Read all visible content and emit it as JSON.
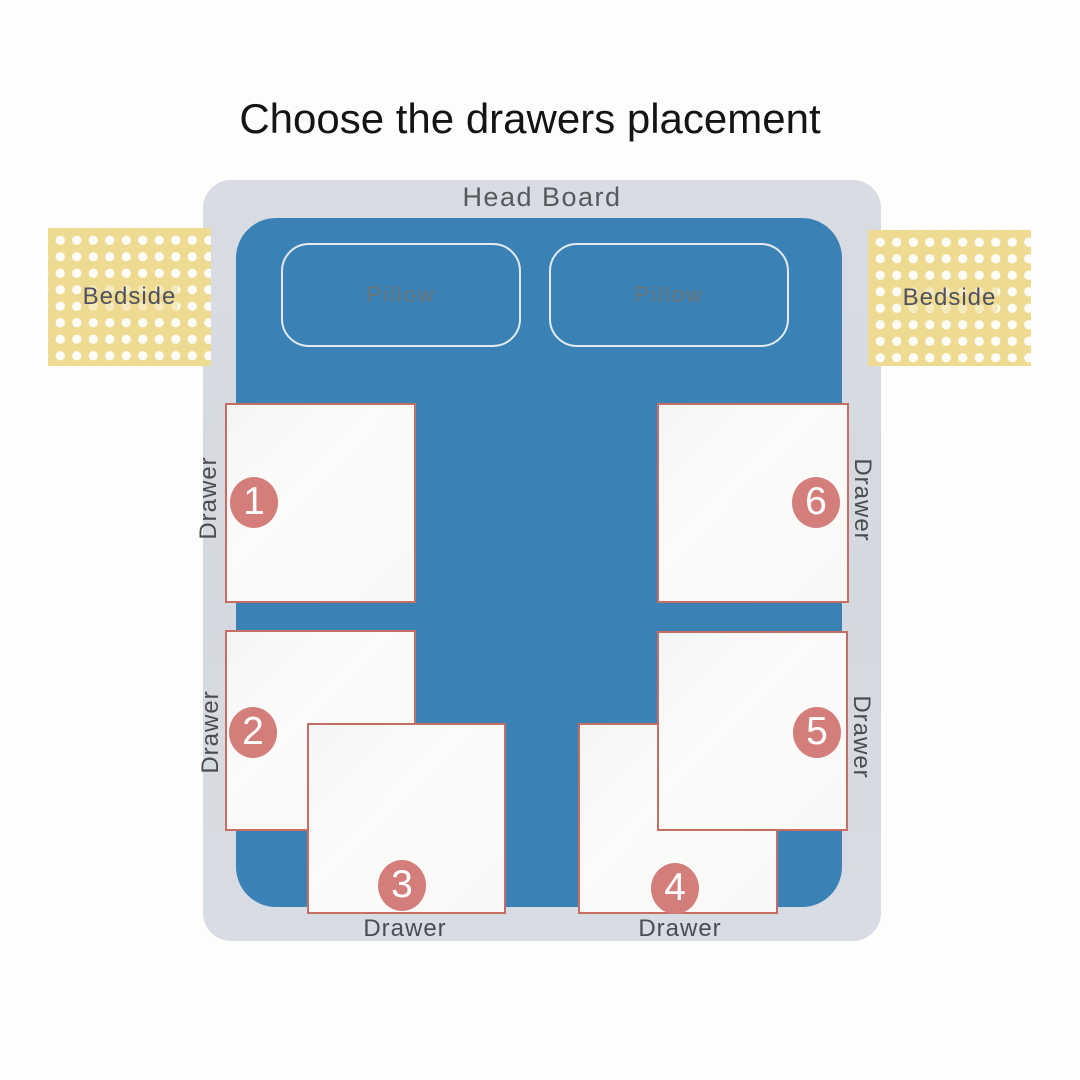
{
  "title": "Choose the drawers placement",
  "diagram": {
    "head_board_label": "Head Board",
    "pillow_left_label": "Pillow",
    "pillow_right_label": "Pillow",
    "bedside_left_label": "Bedside",
    "bedside_right_label": "Bedside",
    "drawers": [
      {
        "number": "1",
        "label": "Drawer",
        "position": "left-top"
      },
      {
        "number": "2",
        "label": "Drawer",
        "position": "left-middle"
      },
      {
        "number": "3",
        "label": "Drawer",
        "position": "bottom-left"
      },
      {
        "number": "4",
        "label": "Drawer",
        "position": "bottom-right"
      },
      {
        "number": "5",
        "label": "Drawer",
        "position": "right-middle"
      },
      {
        "number": "6",
        "label": "Drawer",
        "position": "right-top"
      }
    ]
  },
  "colors": {
    "bed_blue": "#3a82b6",
    "frame_gray": "#d6d9e0",
    "bedside_yellow": "#eeda90",
    "drawer_border_salmon": "#c76e64",
    "badge_rose": "#d37e7a",
    "label_gray": "#4b4c4f"
  }
}
